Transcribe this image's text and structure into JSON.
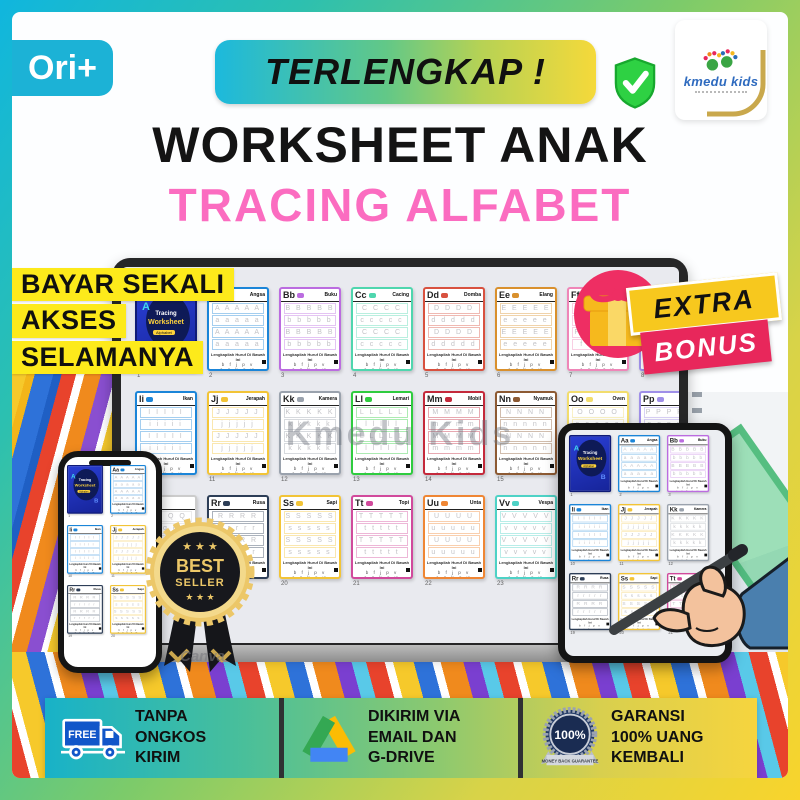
{
  "brand": {
    "name": "kmedu kids"
  },
  "header": {
    "ori_label": "Ori+",
    "banner_label": "TERLENGKAP !",
    "title": "WORKSHEET ANAK",
    "subtitle": "TRACING ALFABET"
  },
  "promo": {
    "pay_once_lines": [
      "BAYAR SEKALI",
      "AKSES",
      "SELAMANYA"
    ],
    "extra_label": "EXTRA",
    "bonus_label": "BONUS"
  },
  "badge": {
    "stars_top": "★ ★ ★",
    "line1": "BEST",
    "line2": "SELLER",
    "stars_bottom": "★ ★ ★"
  },
  "watermark": "Kmedu Kids",
  "canva_watermark": "Canva",
  "worksheets": {
    "caption": "Lengkapilah Huruf Di Bawah Ini",
    "fill_letters": "b f j p v",
    "fill_letters2": "c g k q w",
    "catalog": {
      "cover": {
        "type": "cover",
        "line1": "Tracing",
        "line2": "Worksheet",
        "line3": "Alphabet",
        "letter_a": "A",
        "letter_b": "B"
      },
      "Aa": {
        "letter": "Aa",
        "name": "Angsa",
        "color": "#1b85d8"
      },
      "Bb": {
        "letter": "Bb",
        "name": "Buku",
        "color": "#bb6ce0"
      },
      "Cc": {
        "letter": "Cc",
        "name": "Cacing",
        "color": "#4fd6ae"
      },
      "Dd": {
        "letter": "Dd",
        "name": "Domba",
        "color": "#d8513f"
      },
      "Ee": {
        "letter": "Ee",
        "name": "Elang",
        "color": "#d9902d"
      },
      "Ff": {
        "letter": "Ff",
        "name": "",
        "color": "#ef86b8"
      },
      "Gg": {
        "letter": "Gg",
        "name": "",
        "color": "#9f8fe8"
      },
      "Ii": {
        "letter": "Ii",
        "name": "Ikan",
        "color": "#1b85d8"
      },
      "Jj": {
        "letter": "Jj",
        "name": "Jerapah",
        "color": "#f2c437"
      },
      "Kk": {
        "letter": "Kk",
        "name": "Kamera",
        "color": "#9aa2ad"
      },
      "Ll": {
        "letter": "Ll",
        "name": "Lemari",
        "color": "#2fcc3f"
      },
      "Mm": {
        "letter": "Mm",
        "name": "Mobil",
        "color": "#c4293b"
      },
      "Nn": {
        "letter": "Nn",
        "name": "Nyamuk",
        "color": "#8d5a33"
      },
      "Oo": {
        "letter": "Oo",
        "name": "Oven",
        "color": "#f2dd6e"
      },
      "Pp": {
        "letter": "Pp",
        "name": "",
        "color": "#9f8fe8"
      },
      "Qq": {
        "letter": "Qq",
        "name": "",
        "color": "#cccccc"
      },
      "Rr": {
        "letter": "Rr",
        "name": "Rusa",
        "color": "#2d3e57"
      },
      "Ss": {
        "letter": "Ss",
        "name": "Sapi",
        "color": "#f2c437"
      },
      "Tt": {
        "letter": "Tt",
        "name": "Topi",
        "color": "#d14a9c"
      },
      "Uu": {
        "letter": "Uu",
        "name": "Unta",
        "color": "#ef8634"
      },
      "Vv": {
        "letter": "Vv",
        "name": "Vespa",
        "color": "#4ed2c6"
      },
      "Ww": {
        "letter": "Ww",
        "name": "",
        "color": "#8f969e"
      }
    },
    "laptop_rows": [
      {
        "cards": [
          "cover",
          "Aa",
          "Bb",
          "Cc",
          "Dd",
          "Ee",
          "Ff",
          "Gg"
        ],
        "pages": [
          1,
          2,
          3,
          4,
          5,
          6,
          7,
          8
        ]
      },
      {
        "cards": [
          "Ii",
          "Jj",
          "Kk",
          "Ll",
          "Mm",
          "Nn",
          "Oo",
          "Pp"
        ],
        "pages": [
          10,
          11,
          12,
          13,
          14,
          15,
          16,
          17
        ]
      },
      {
        "cards": [
          "Qq",
          "Rr",
          "Ss",
          "Tt",
          "Uu",
          "Vv",
          "Ww"
        ],
        "pages": [
          18,
          19,
          20,
          21,
          22,
          23,
          24
        ]
      }
    ],
    "phone_rows": [
      {
        "cards": [
          "cover",
          "Aa"
        ],
        "pages": [
          1,
          2
        ]
      },
      {
        "cards": [
          "Ii",
          "Jj"
        ],
        "pages": [
          10,
          11
        ]
      },
      {
        "cards": [
          "Rr",
          "Ss"
        ],
        "pages": [
          19,
          20
        ]
      }
    ],
    "tablet_rows": [
      {
        "cards": [
          "cover",
          "Aa",
          "Bb"
        ],
        "pages": [
          1,
          2,
          3
        ]
      },
      {
        "cards": [
          "Ii",
          "Jj",
          "Kk"
        ],
        "pages": [
          10,
          11,
          12
        ]
      },
      {
        "cards": [
          "Rr",
          "Ss",
          "Tt"
        ],
        "pages": [
          19,
          20,
          21
        ]
      }
    ]
  },
  "footer": {
    "items": [
      {
        "icon": "free-truck-icon",
        "icon_label": "FREE",
        "lines": [
          "TANPA",
          "ONGKOS",
          "KIRIM"
        ]
      },
      {
        "icon": "gdrive-icon",
        "lines": [
          "DIKIRIM VIA",
          "EMAIL DAN",
          "G-DRIVE"
        ]
      },
      {
        "icon": "money-back-badge-icon",
        "badge_value": "100%",
        "ribbon_text": "MONEY BACK GUARANTEE",
        "lines": [
          "GARANSI",
          "100% UANG",
          "KEMBALI"
        ]
      }
    ]
  },
  "colors": {
    "frame_cyan": "#10b6de",
    "frame_green": "#7ccb6a",
    "frame_yellow": "#f8d42c",
    "pink": "#fb6cc0",
    "highlight_yellow": "#fdea1b",
    "bonus_red": "#e8275b",
    "bonus_yellow": "#f7c81e",
    "shield_green": "#2ed143",
    "truck_blue": "#1156c9",
    "drive_green": "#34a853",
    "drive_yellow": "#fbbc04",
    "drive_blue": "#4285f4"
  }
}
